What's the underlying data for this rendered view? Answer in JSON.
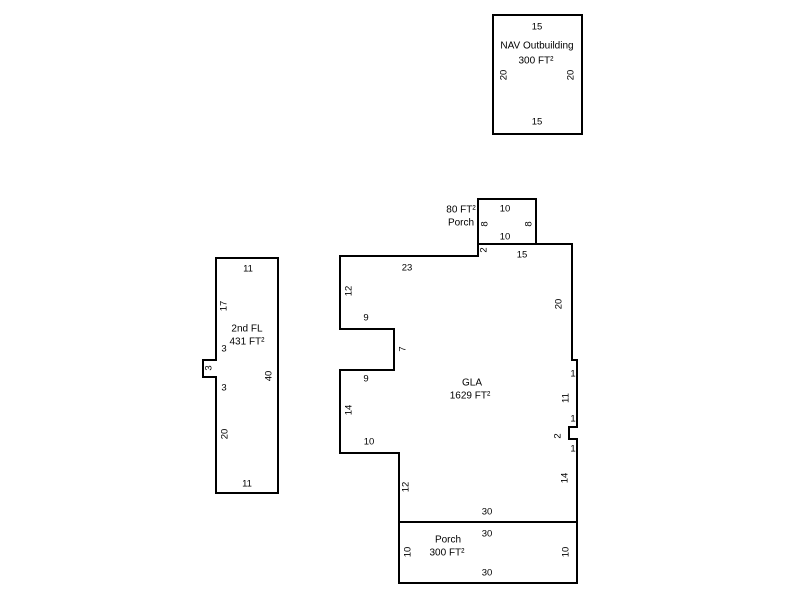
{
  "canvas": {
    "width": 800,
    "height": 600,
    "background_color": "#ffffff",
    "line_color": "#000000",
    "text_color": "#000000"
  },
  "sketch": {
    "shapes": [
      {
        "name": "gla",
        "title": "GLA",
        "area": "1629 FT²",
        "points": [
          [
            340,
            256
          ],
          [
            478,
            256
          ],
          [
            478,
            244
          ],
          [
            572,
            244
          ],
          [
            572,
            360
          ],
          [
            577,
            360
          ],
          [
            577,
            427
          ],
          [
            569,
            427
          ],
          [
            569,
            439
          ],
          [
            577,
            439
          ],
          [
            577,
            522
          ],
          [
            399,
            522
          ],
          [
            399,
            453
          ],
          [
            340,
            453
          ],
          [
            340,
            370
          ],
          [
            394,
            370
          ],
          [
            394,
            329
          ],
          [
            340,
            329
          ]
        ],
        "labels": [
          {
            "text": "23",
            "x": 407,
            "y": 268,
            "rotated": false,
            "kind": "dim"
          },
          {
            "text": "2",
            "x": 484,
            "y": 250,
            "rotated": true,
            "kind": "dim"
          },
          {
            "text": "15",
            "x": 522,
            "y": 255,
            "rotated": false,
            "kind": "dim"
          },
          {
            "text": "12",
            "x": 349,
            "y": 291,
            "rotated": true,
            "kind": "dim"
          },
          {
            "text": "20",
            "x": 559,
            "y": 304,
            "rotated": true,
            "kind": "dim"
          },
          {
            "text": "9",
            "x": 366,
            "y": 318,
            "rotated": false,
            "kind": "dim"
          },
          {
            "text": "7",
            "x": 403,
            "y": 349,
            "rotated": true,
            "kind": "dim"
          },
          {
            "text": "1",
            "x": 573,
            "y": 374,
            "rotated": false,
            "kind": "dim"
          },
          {
            "text": "9",
            "x": 366,
            "y": 379,
            "rotated": false,
            "kind": "dim"
          },
          {
            "text": "GLA",
            "x": 472,
            "y": 383,
            "rotated": false,
            "kind": "name"
          },
          {
            "text": "1629 FT²",
            "x": 470,
            "y": 396,
            "rotated": false,
            "kind": "name"
          },
          {
            "text": "11",
            "x": 566,
            "y": 398,
            "rotated": true,
            "kind": "dim"
          },
          {
            "text": "14",
            "x": 349,
            "y": 410,
            "rotated": true,
            "kind": "dim"
          },
          {
            "text": "1",
            "x": 573,
            "y": 419,
            "rotated": false,
            "kind": "dim"
          },
          {
            "text": "2",
            "x": 558,
            "y": 436,
            "rotated": true,
            "kind": "dim"
          },
          {
            "text": "10",
            "x": 369,
            "y": 442,
            "rotated": false,
            "kind": "dim"
          },
          {
            "text": "1",
            "x": 573,
            "y": 449,
            "rotated": false,
            "kind": "dim"
          },
          {
            "text": "14",
            "x": 565,
            "y": 478,
            "rotated": true,
            "kind": "dim"
          },
          {
            "text": "12",
            "x": 406,
            "y": 487,
            "rotated": true,
            "kind": "dim"
          },
          {
            "text": "30",
            "x": 487,
            "y": 512,
            "rotated": false,
            "kind": "dim"
          }
        ]
      },
      {
        "name": "top-porch",
        "title": "Porch",
        "area": "80 FT²",
        "points": [
          [
            478,
            199
          ],
          [
            536,
            199
          ],
          [
            536,
            244
          ],
          [
            478,
            244
          ]
        ],
        "labels": [
          {
            "text": "80 FT²",
            "x": 461,
            "y": 210,
            "rotated": false,
            "kind": "name"
          },
          {
            "text": "Porch",
            "x": 461,
            "y": 223,
            "rotated": false,
            "kind": "name"
          },
          {
            "text": "10",
            "x": 505,
            "y": 209,
            "rotated": false,
            "kind": "dim"
          },
          {
            "text": "8",
            "x": 485,
            "y": 224,
            "rotated": true,
            "kind": "dim"
          },
          {
            "text": "8",
            "x": 529,
            "y": 224,
            "rotated": true,
            "kind": "dim"
          },
          {
            "text": "10",
            "x": 505,
            "y": 237,
            "rotated": false,
            "kind": "dim"
          }
        ]
      },
      {
        "name": "bottom-porch",
        "title": "Porch",
        "area": "300 FT²",
        "points": [
          [
            399,
            522
          ],
          [
            577,
            522
          ],
          [
            577,
            583
          ],
          [
            399,
            583
          ]
        ],
        "labels": [
          {
            "text": "30",
            "x": 487,
            "y": 534,
            "rotated": false,
            "kind": "dim"
          },
          {
            "text": "Porch",
            "x": 448,
            "y": 540,
            "rotated": false,
            "kind": "name"
          },
          {
            "text": "300 FT²",
            "x": 447,
            "y": 553,
            "rotated": false,
            "kind": "name"
          },
          {
            "text": "10",
            "x": 408,
            "y": 552,
            "rotated": true,
            "kind": "dim"
          },
          {
            "text": "10",
            "x": 566,
            "y": 552,
            "rotated": true,
            "kind": "dim"
          },
          {
            "text": "30",
            "x": 487,
            "y": 573,
            "rotated": false,
            "kind": "dim"
          }
        ]
      },
      {
        "name": "second-floor",
        "title": "2nd FL",
        "area": "431 FT²",
        "points": [
          [
            216,
            258
          ],
          [
            278,
            258
          ],
          [
            278,
            493
          ],
          [
            216,
            493
          ],
          [
            216,
            377
          ],
          [
            203,
            377
          ],
          [
            203,
            360
          ],
          [
            216,
            360
          ]
        ],
        "labels": [
          {
            "text": "11",
            "x": 248,
            "y": 269,
            "rotated": false,
            "kind": "dim"
          },
          {
            "text": "17",
            "x": 224,
            "y": 306,
            "rotated": true,
            "kind": "dim"
          },
          {
            "text": "2nd FL",
            "x": 247,
            "y": 329,
            "rotated": false,
            "kind": "name"
          },
          {
            "text": "431 FT²",
            "x": 247,
            "y": 342,
            "rotated": false,
            "kind": "name"
          },
          {
            "text": "3",
            "x": 224,
            "y": 349,
            "rotated": false,
            "kind": "dim"
          },
          {
            "text": "3",
            "x": 209,
            "y": 368,
            "rotated": true,
            "kind": "dim"
          },
          {
            "text": "40",
            "x": 269,
            "y": 376,
            "rotated": true,
            "kind": "dim"
          },
          {
            "text": "3",
            "x": 224,
            "y": 388,
            "rotated": false,
            "kind": "dim"
          },
          {
            "text": "20",
            "x": 225,
            "y": 434,
            "rotated": true,
            "kind": "dim"
          },
          {
            "text": "11",
            "x": 247,
            "y": 484,
            "rotated": false,
            "kind": "dim"
          }
        ]
      },
      {
        "name": "nav-outbuilding",
        "title": "NAV Outbuilding",
        "area": "300 FT²",
        "points": [
          [
            493,
            15
          ],
          [
            582,
            15
          ],
          [
            582,
            134
          ],
          [
            493,
            134
          ]
        ],
        "labels": [
          {
            "text": "15",
            "x": 537,
            "y": 27,
            "rotated": false,
            "kind": "dim"
          },
          {
            "text": "NAV Outbuilding",
            "x": 537,
            "y": 46,
            "rotated": false,
            "kind": "name"
          },
          {
            "text": "300 FT²",
            "x": 536,
            "y": 61,
            "rotated": false,
            "kind": "name"
          },
          {
            "text": "20",
            "x": 504,
            "y": 75,
            "rotated": true,
            "kind": "dim"
          },
          {
            "text": "20",
            "x": 571,
            "y": 75,
            "rotated": true,
            "kind": "dim"
          },
          {
            "text": "15",
            "x": 537,
            "y": 122,
            "rotated": false,
            "kind": "dim"
          }
        ]
      }
    ]
  }
}
